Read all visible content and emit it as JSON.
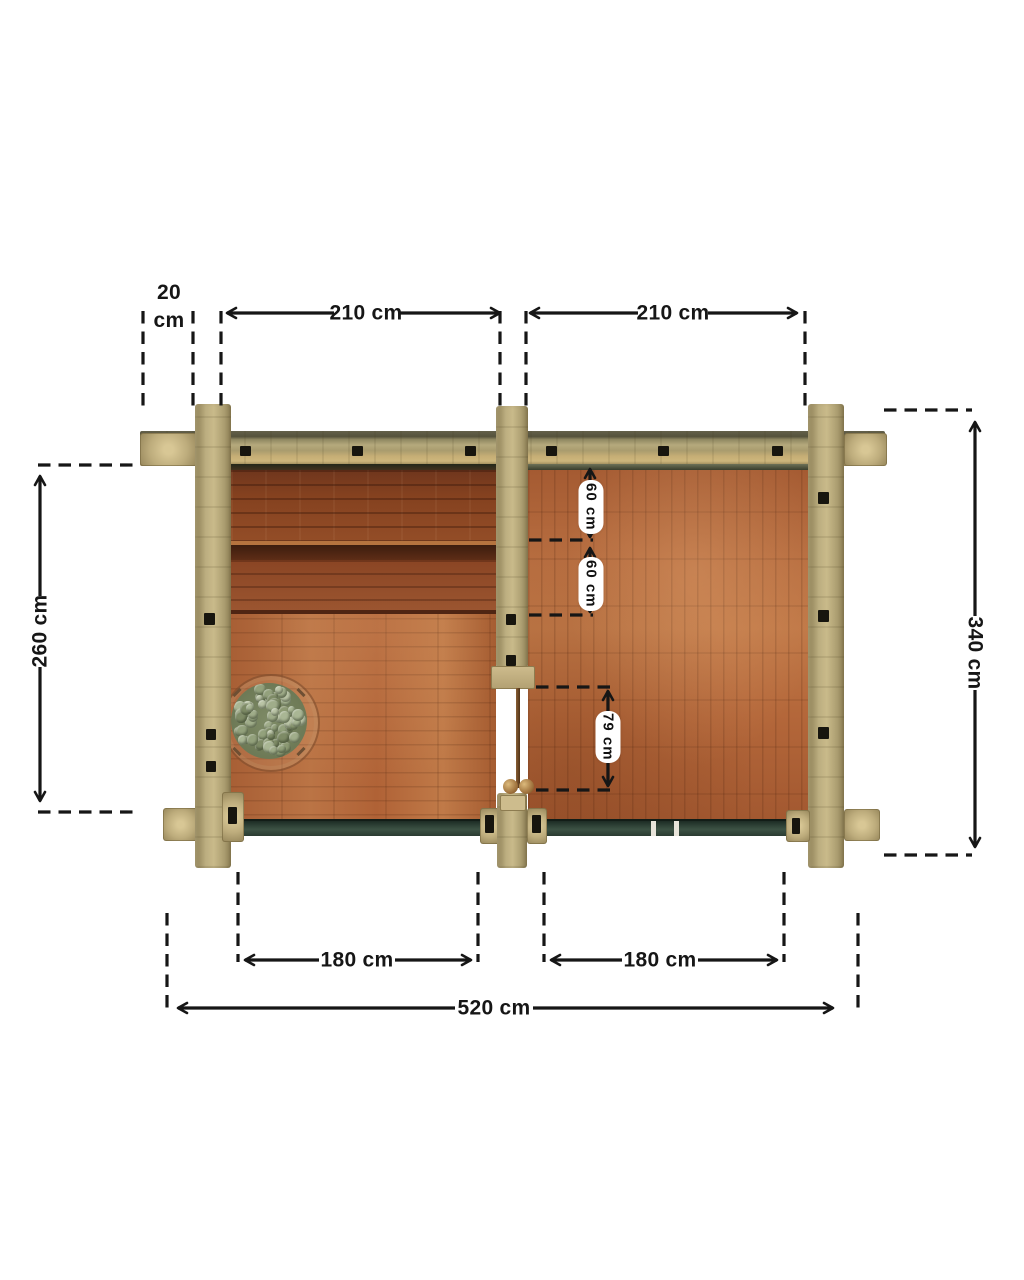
{
  "plan": {
    "top": {
      "wall_thickness_value": "20",
      "wall_thickness_unit": "cm",
      "left_room_width": "210 cm",
      "right_room_width": "210 cm"
    },
    "left": {
      "interior_depth": "260 cm"
    },
    "right": {
      "overall_depth": "340 cm"
    },
    "interior": {
      "bench_row_1": "60 cm",
      "bench_row_2": "60 cm",
      "door_opening": "79 cm"
    },
    "bottom": {
      "left_glass_width": "180 cm",
      "right_glass_width": "180 cm",
      "overall_width": "520 cm"
    }
  },
  "colors": {
    "dimension_ink": "#161616",
    "log_wall_khaki": "#b5a97c",
    "floor_orange": "#b4673a",
    "bench_brown": "#8a4524",
    "glass_wall_teal": "#31453b",
    "stone_sage": "#9cab8b",
    "label_pill_bg": "#ffffff"
  }
}
